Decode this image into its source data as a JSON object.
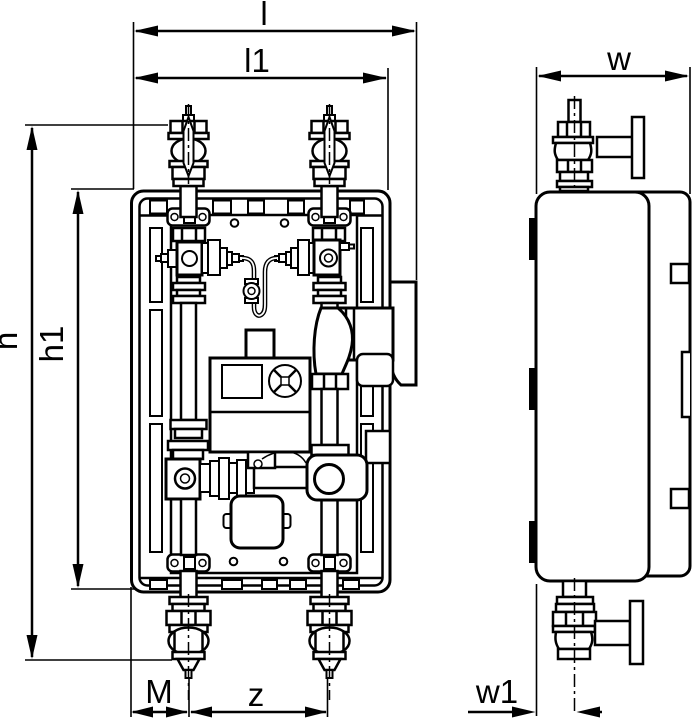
{
  "drawing": {
    "background_color": "#ffffff",
    "line_color": "#000000"
  },
  "dimension_labels": {
    "l": "l",
    "l1": "l1",
    "h": "h",
    "h1": "h1",
    "M": "M",
    "z": "z",
    "w": "w",
    "w1": "w1"
  },
  "views": {
    "front_view": {
      "dimension_ids": [
        "l",
        "l1",
        "h",
        "h1",
        "M",
        "z"
      ]
    },
    "side_view": {
      "dimension_ids": [
        "w",
        "w1"
      ]
    }
  }
}
